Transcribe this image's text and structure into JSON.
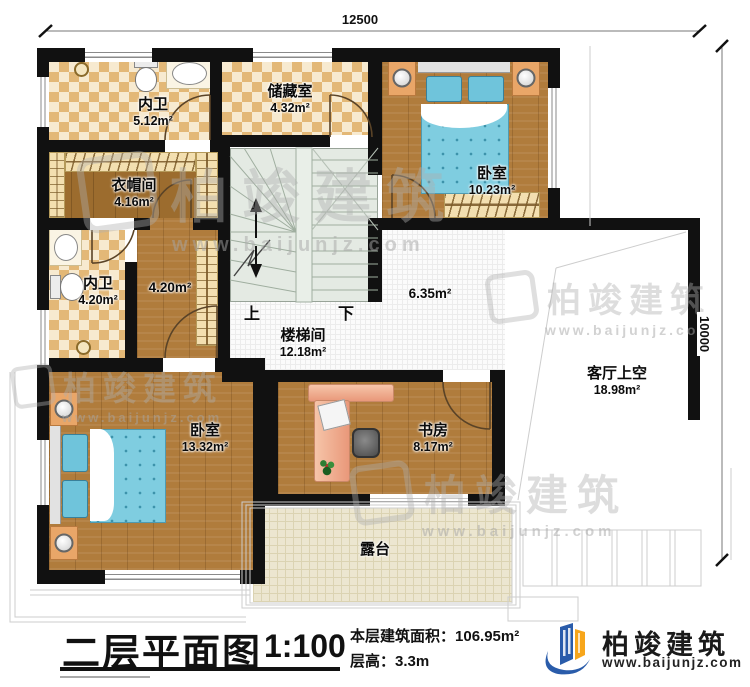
{
  "dimensions": {
    "top": "12500",
    "right": "10000"
  },
  "title_block": {
    "title": "二层平面图",
    "scale": "1:100",
    "area_label": "本层建筑面积：",
    "area_value": "106.95m²",
    "height_label": "层高：",
    "height_value": "3.3m"
  },
  "brand": {
    "name": "柏竣建筑",
    "url": "www.baijunjz.com",
    "blue": "#2a5caa",
    "orange": "#f7a61b"
  },
  "watermark": {
    "name": "柏竣建筑",
    "url": "www.baijunjz.com"
  },
  "stairs": {
    "up": "上",
    "down": "下"
  },
  "rooms": [
    {
      "name": "内卫",
      "area": "5.12m²"
    },
    {
      "name": "储藏室",
      "area": "4.32m²"
    },
    {
      "name": "卧室",
      "area": "10.23m²"
    },
    {
      "name": "衣帽间",
      "area": "4.16m²"
    },
    {
      "name": "内卫",
      "area": "4.20m²"
    },
    {
      "name": "",
      "area": "4.20m²"
    },
    {
      "name": "楼梯间",
      "area": "12.18m²"
    },
    {
      "name": "",
      "area": "6.35m²"
    },
    {
      "name": "客厅上空",
      "area": "18.98m²"
    },
    {
      "name": "卧室",
      "area": "13.32m²"
    },
    {
      "name": "书房",
      "area": "8.17m²"
    },
    {
      "name": "露台",
      "area": ""
    }
  ],
  "icons": {
    "toilet": "toilet-icon",
    "sink": "sink-icon",
    "shower": "shower-icon",
    "bed": "bed-icon",
    "nightstand_lamp": "lamp-icon",
    "wardrobe": "wardrobe-icon",
    "desk": "desk-icon",
    "chair": "chair-icon",
    "laptop": "laptop-icon",
    "plant": "plant-icon",
    "logo": "brand-logo-icon"
  },
  "colors": {
    "wall": "#111111",
    "tile_dark": "#e3b877",
    "tile_light": "#f7ead0",
    "wood": "#b07c3c",
    "wood_dark": "#9c6c2e",
    "bed": "#7fcde0",
    "stair": "#e4eae3",
    "terrace": "#ece6d0"
  }
}
